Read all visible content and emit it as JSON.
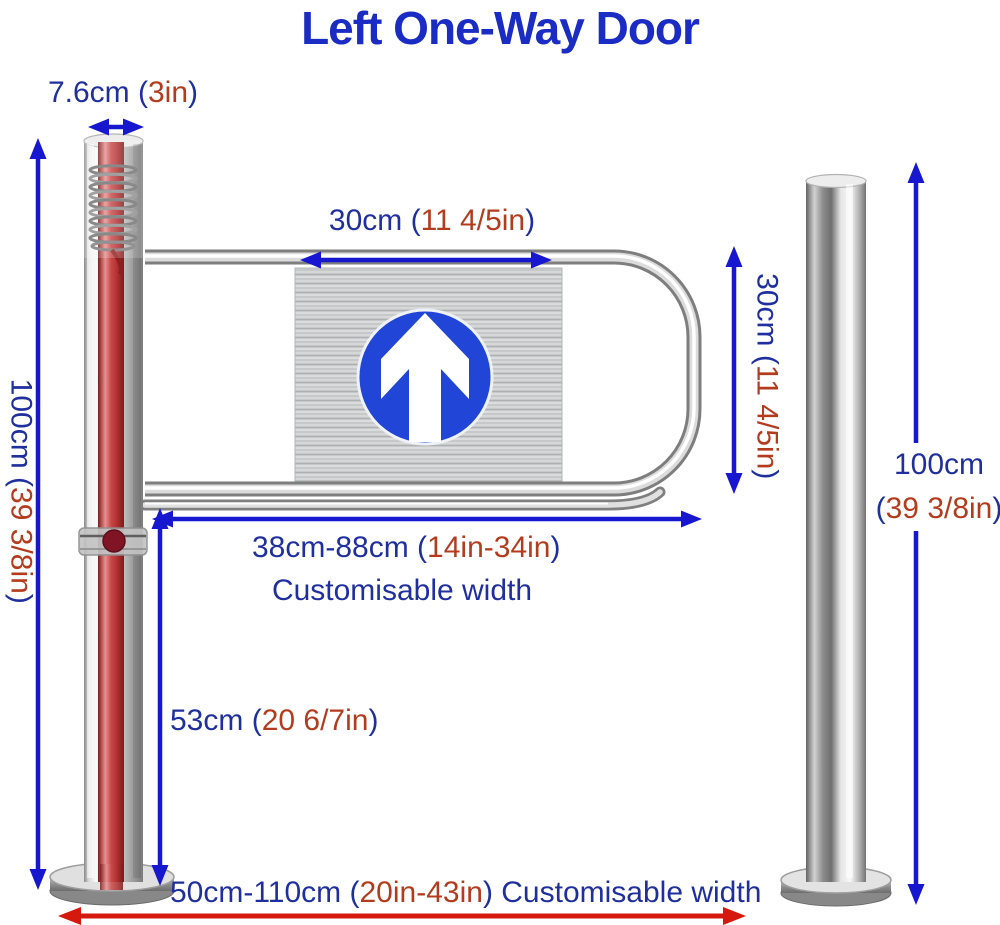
{
  "title": "Left One-Way Door",
  "colors": {
    "title_blue": "#1b2cc4",
    "label_blue": "#1f2f9e",
    "label_red": "#b43c1e",
    "arrow_blue": "#1717d0",
    "arrow_red": "#d6190e",
    "sign_blue": "#2145d6"
  },
  "labels": {
    "post_width": {
      "blue": "7.6cm (",
      "red": "3in",
      "blue_end": ")"
    },
    "sign_width": {
      "blue": "30cm (",
      "red": "11 4/5in",
      "blue_end": ")"
    },
    "sign_height": {
      "blue": "30cm (",
      "red": "11 4/5in",
      "blue_end": ")"
    },
    "post_height": {
      "blue": "100cm (",
      "red": "39 3/8in",
      "blue_end": ")"
    },
    "arm_width": {
      "blue": "38cm-88cm (",
      "red": "14in-34in",
      "blue_end": ")"
    },
    "arm_width_note": "Customisable width",
    "arm_clearance": {
      "blue": "53cm (",
      "red": "20 6/7in",
      "blue_end": ")"
    },
    "pole_height_value": "100cm",
    "pole_height_imperial": {
      "blue": "(",
      "red": "39 3/8in",
      "blue_end": ")"
    },
    "total_width": {
      "blue": "50cm-110cm (",
      "red": "20in-43in",
      "blue_end": ") Customisable width"
    }
  }
}
